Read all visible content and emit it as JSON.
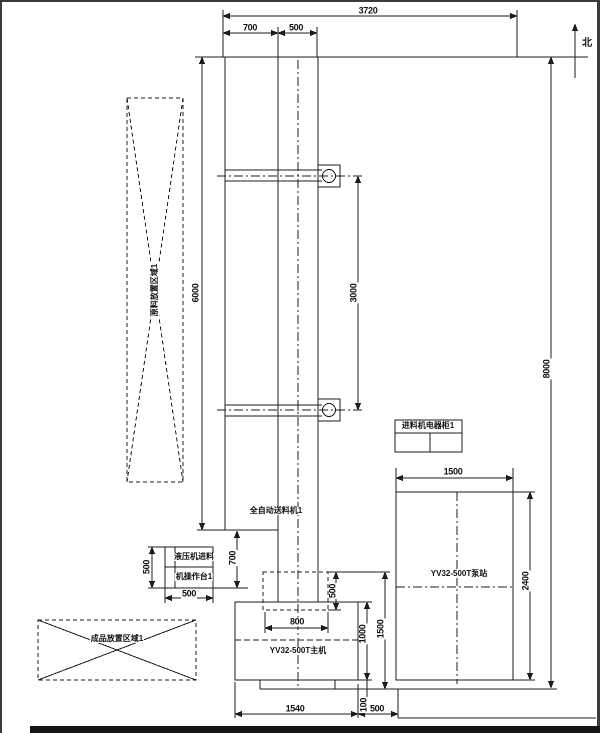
{
  "colors": {
    "line": "#1c1c1c",
    "background": "#ffffff"
  },
  "compass": {
    "north_label": "北"
  },
  "dims": {
    "overall_width": "3720",
    "top_seg_a": "700",
    "top_seg_b": "500",
    "frame_height": "6000",
    "arm_spacing": "3000",
    "site_depth": "8000",
    "feeder_offset": "700",
    "console_height": "500",
    "console_width": "500",
    "slide_height": "500",
    "slide_width": "800",
    "press_body": "1000",
    "press_total": "1500",
    "base_lip": "100",
    "press_width": "1540",
    "press_gap": "500",
    "pump_width": "1500",
    "pump_depth": "2400"
  },
  "labels": {
    "raw_area": "原料放置区域1",
    "finished_area": "成品放置区域1",
    "feeder": "全自动送料机1",
    "cabinet": "进料机电器柜1",
    "console_line1": "液压机进料",
    "console_line2": "机操作台1",
    "press": "YV32-500T主机",
    "pump": "YV32-500T泵站"
  }
}
